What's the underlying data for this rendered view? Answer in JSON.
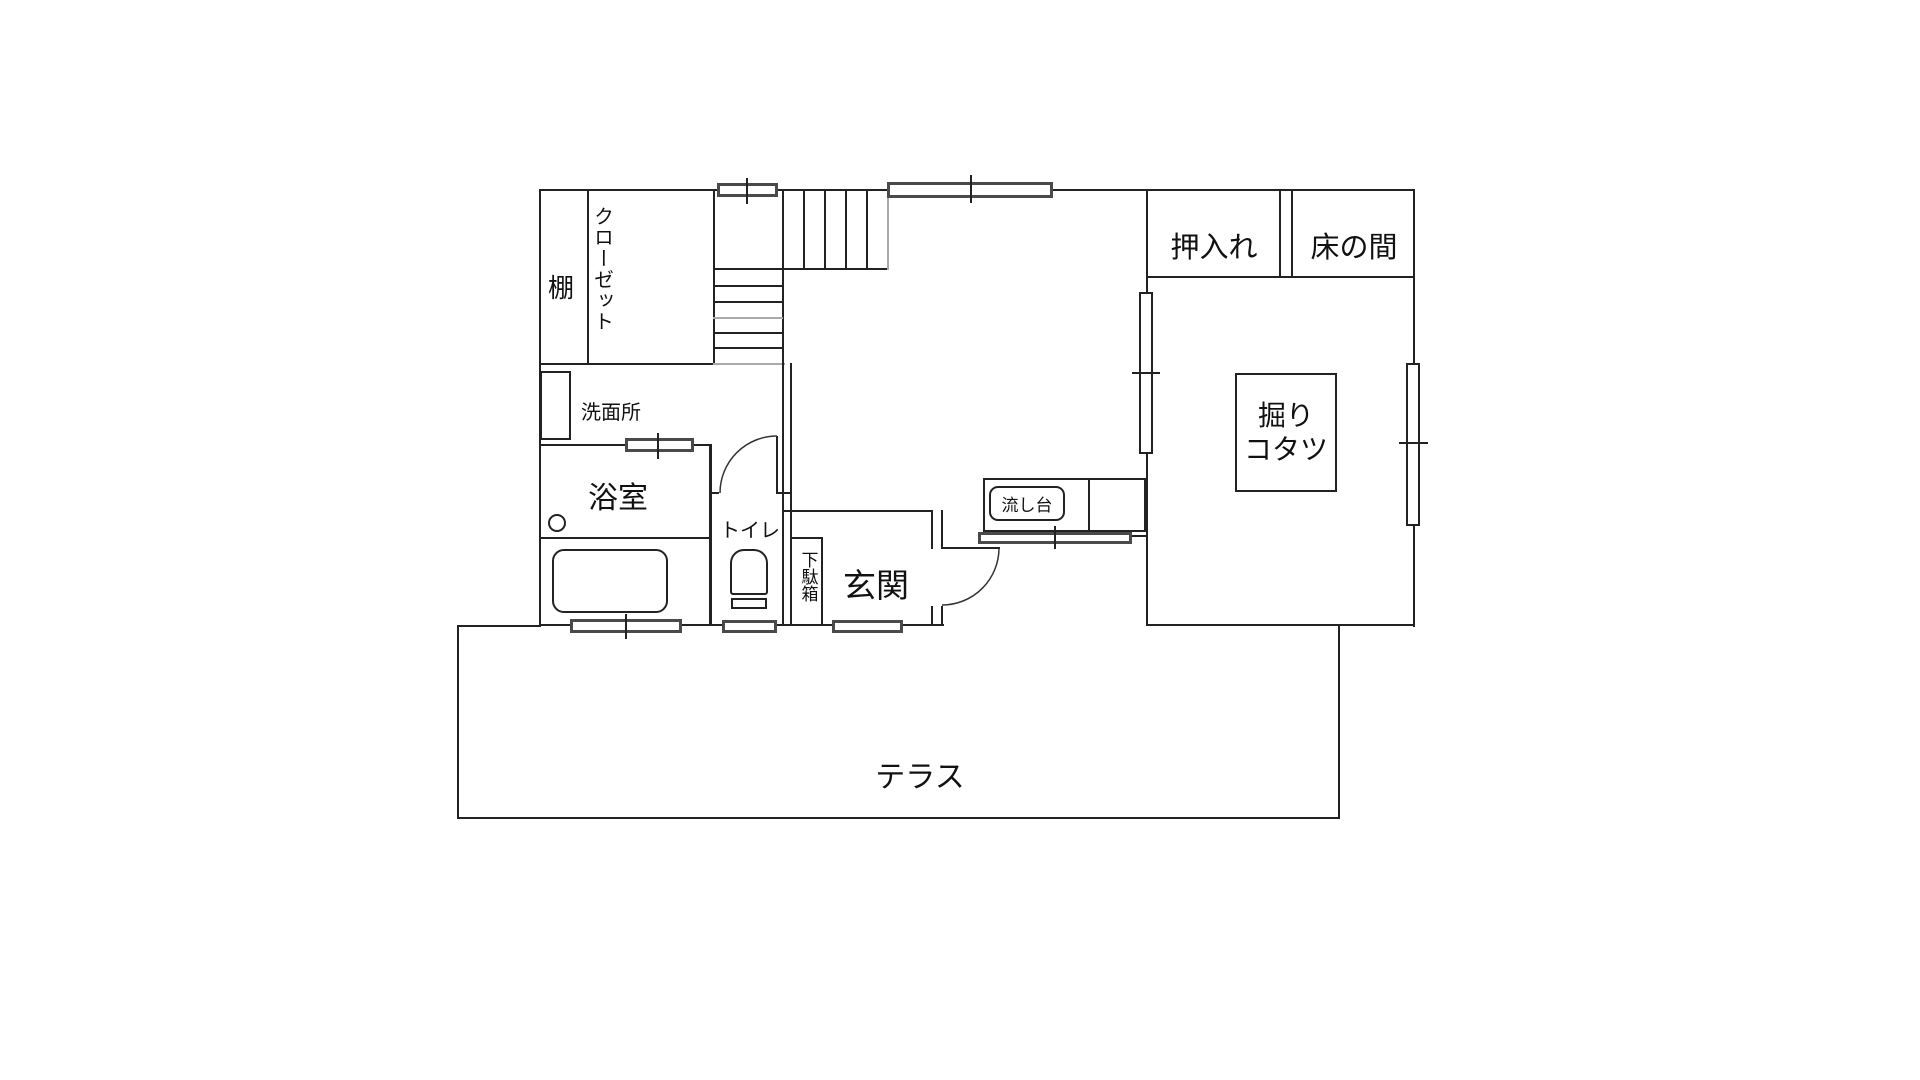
{
  "colors": {
    "wall": "#222222",
    "winb": "#4a4a4a",
    "gray": "#aaaaaa",
    "text": "#111111",
    "bg": "#ffffff"
  },
  "labels": {
    "shelf": "棚",
    "closet": "クローゼット",
    "washroom": "洗面所",
    "bathroom": "浴室",
    "toilet": "トイレ",
    "shoe_cabinet": "下駄箱",
    "entrance": "玄関",
    "sink": "流し台",
    "oshiire": "押入れ",
    "tokonoma": "床の間",
    "kotatsu_line1": "掘り",
    "kotatsu_line2": "コタツ",
    "terrace": "テラス"
  }
}
